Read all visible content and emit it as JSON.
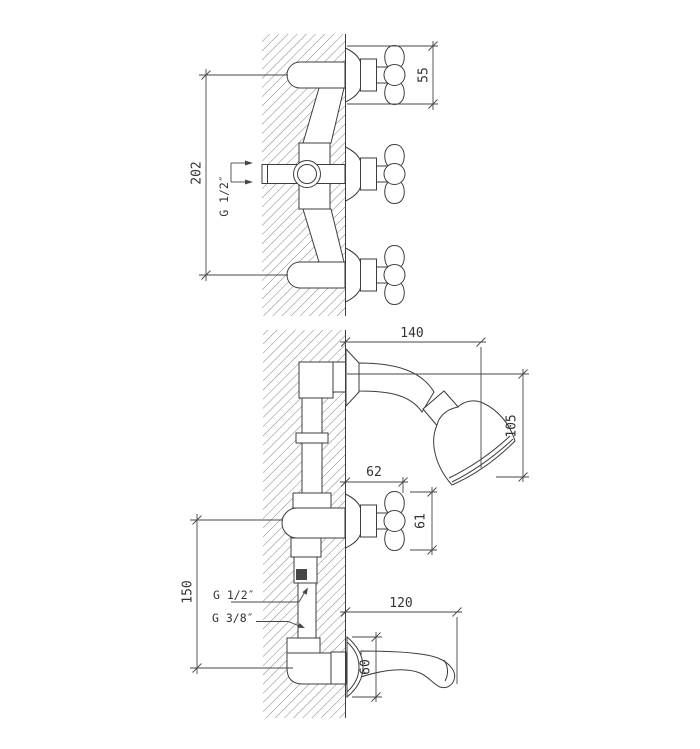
{
  "colors": {
    "line": "#3d3d3d",
    "text": "#333333",
    "background": "#ffffff",
    "hatch": "#5a5a5a"
  },
  "upper_view": {
    "dim_span": "202",
    "dim_handle": "55",
    "thread_inlet": "G 1/2″"
  },
  "lower_view": {
    "dim_arm_reach": "140",
    "dim_head_drop": "105",
    "dim_valve_depth": "62",
    "dim_handle": "61",
    "dim_valve_to_spout": "150",
    "thread_upper": "G 1/2″",
    "thread_lower": "G 3/8″",
    "dim_spout_reach": "120",
    "dim_flange": "60"
  }
}
